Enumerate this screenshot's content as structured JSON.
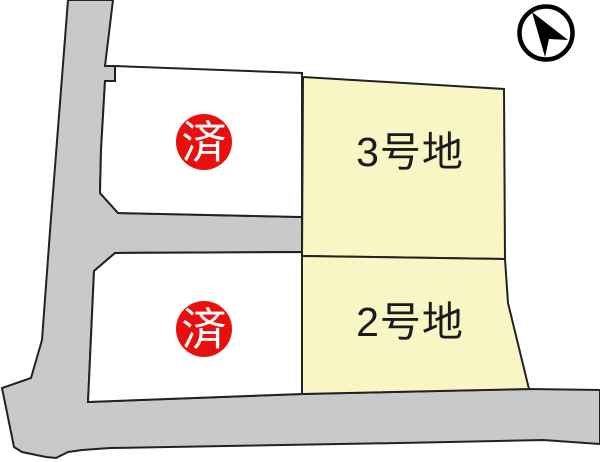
{
  "map": {
    "kind": "residential-lot-plan",
    "lots": [
      {
        "id": "lot-3",
        "label": "3号地",
        "fill": "#f8f6c4"
      },
      {
        "id": "lot-2",
        "label": "2号地",
        "fill": "#f8f6c4"
      }
    ],
    "sold_badge": {
      "label": "済",
      "color": "#e8100e"
    },
    "icons": {
      "north_arrow": "north-arrow-icon"
    }
  },
  "colors": {
    "lot_fill": "#f8f6c4",
    "sold_fill": "#ffffff",
    "road_fill": "#c9c9c9",
    "outline": "#222222",
    "badge_fill": "#e8100e",
    "badge_text": "#ffffff",
    "label_text": "#1b1b1b",
    "compass_color": "#000000",
    "bg": "#ffffff"
  }
}
